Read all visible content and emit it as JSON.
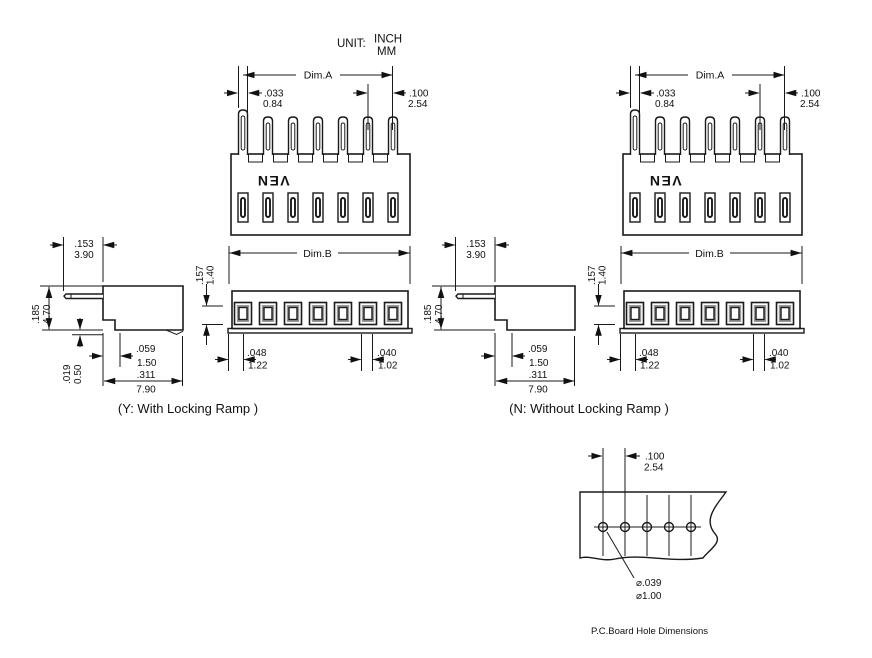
{
  "unit": {
    "label": "UNIT:",
    "inch": "INCH",
    "mm": "MM"
  },
  "logo": "VEN",
  "pin_count": 7,
  "captions": {
    "left": "(Y: With Locking Ramp )",
    "right": "(N: Without Locking Ramp )",
    "pcb": "P.C.Board Hole Dimensions"
  },
  "dims": {
    "dim_a": "Dim.A",
    "dim_b": "Dim.B",
    "pin_width": {
      "inch": ".033",
      "mm": "0.84"
    },
    "pitch": {
      "inch": ".100",
      "mm": "2.54"
    },
    "pin_protrusion": {
      "inch": ".153",
      "mm": "3.90"
    },
    "body_height": {
      "inch": ".185",
      "mm": "4.70"
    },
    "window_height": {
      "inch": ".157",
      "mm": "1.40"
    },
    "standoff": {
      "inch": ".019",
      "mm": "0.50"
    },
    "step": {
      "inch": ".059",
      "mm": "1.50"
    },
    "body_depth": {
      "inch": ".311",
      "mm": "7.90"
    },
    "edge_to_slot": {
      "inch": ".048",
      "mm": "1.22"
    },
    "slot_width": {
      "inch": ".040",
      "mm": "1.02"
    }
  },
  "pcb": {
    "pitch": {
      "inch": ".100",
      "mm": "2.54"
    },
    "hole_dia": {
      "inch": "⌀.039",
      "mm": "⌀1.00"
    },
    "hole_count": 5
  }
}
